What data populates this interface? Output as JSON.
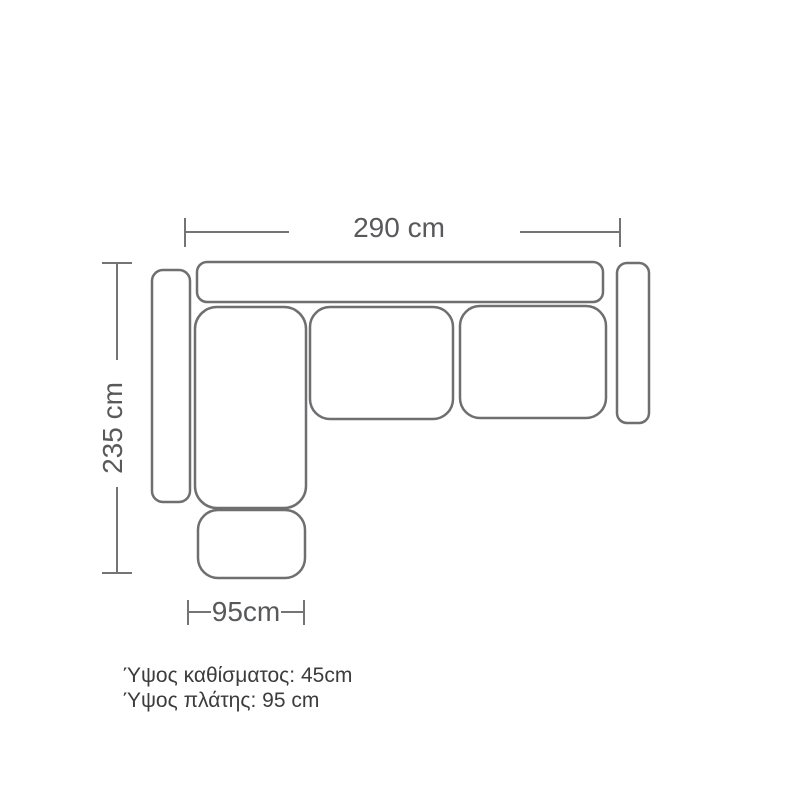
{
  "colors": {
    "background": "#ffffff",
    "outline": "#6e6f71",
    "dim-line": "#737476",
    "dim-text": "#58595b",
    "note-text": "#3c3c3c"
  },
  "dimensions": {
    "overall_width": {
      "label": "290 cm"
    },
    "overall_depth": {
      "label": "235 cm"
    },
    "chaise_width": {
      "label": "95cm"
    }
  },
  "notes": {
    "seat_height": "Ύψος καθίσματος: 45cm",
    "back_height": "Ύψος πλάτης: 95 cm"
  }
}
